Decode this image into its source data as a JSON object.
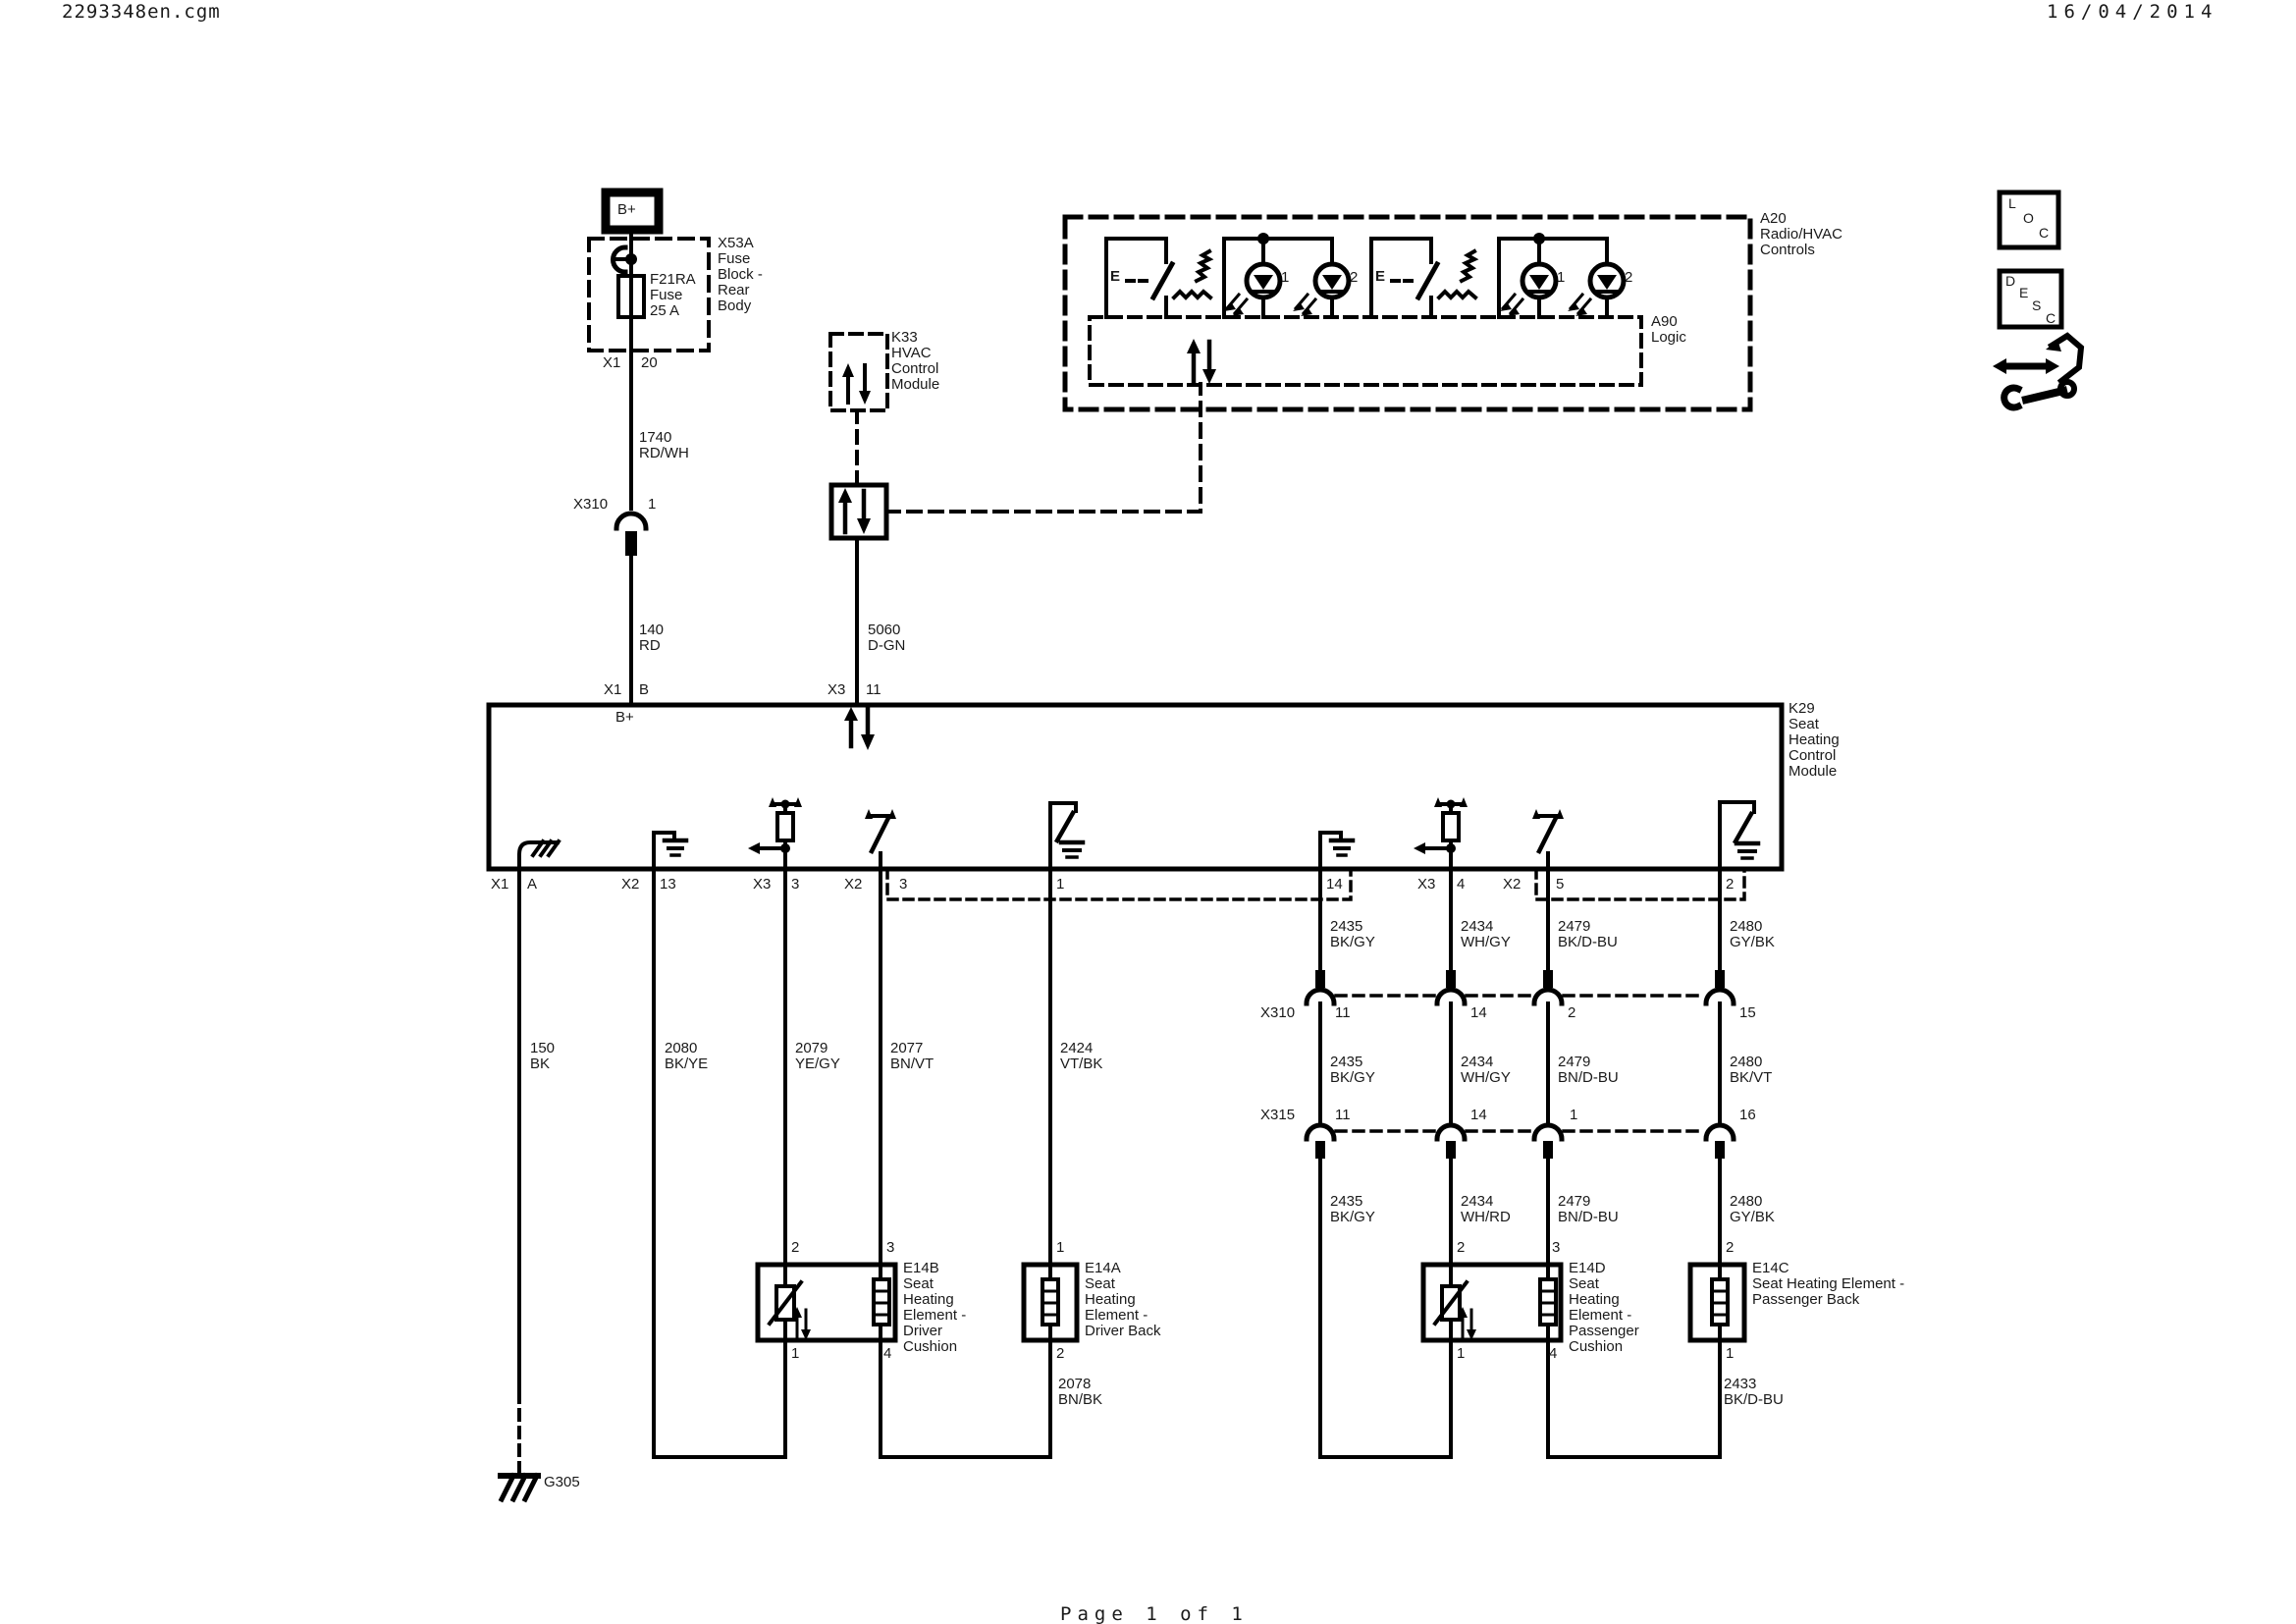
{
  "header": {
    "filename": "2293348en.cgm",
    "date": "16/04/2014"
  },
  "footer": {
    "page_label": "Page 1 of 1"
  },
  "power": {
    "bplus_label": "B+",
    "fuse_label": "F21RA\nFuse\n25 A",
    "fuse_block_label": "X53A\nFuse\nBlock -\nRear\nBody",
    "fuse_out_conn": "X1",
    "fuse_out_pin": "20",
    "wire_1740": "1740\nRD/WH",
    "x310_conn": "X310",
    "x310_pin": "1",
    "wire_140": "140\nRD"
  },
  "hvac": {
    "k33_label": "K33\nHVAC\nControl\nModule",
    "wire_5060": "5060\nD-GN"
  },
  "a20": {
    "label": "A20\nRadio/HVAC\nControls",
    "a90_label": "A90\nLogic",
    "switch_left_label": "E",
    "switch_right_label": "E",
    "led_labels": [
      "1",
      "2",
      "1",
      "2"
    ]
  },
  "k29": {
    "label": "K29\nSeat\nHeating\nControl\nModule",
    "bplus_label": "B+",
    "pin_x1b_conn": "X1",
    "pin_x1b_pin": "B",
    "pin_x311_conn": "X3",
    "pin_x311_pin": "11",
    "bottom_pins": [
      {
        "conn": "X1",
        "pin": "A"
      },
      {
        "conn": "X2",
        "pin": "13"
      },
      {
        "conn": "X3",
        "pin": "3"
      },
      {
        "conn": "X2",
        "pin": "3"
      },
      {
        "conn": "",
        "pin": "1"
      },
      {
        "conn": "",
        "pin": "14"
      },
      {
        "conn": "X3",
        "pin": "4"
      },
      {
        "conn": "X2",
        "pin": "5"
      },
      {
        "conn": "",
        "pin": "2"
      }
    ]
  },
  "wires_left": [
    "150\nBK",
    "2080\nBK/YE",
    "2079\nYE/GY",
    "2077\nBN/VT",
    "2424\nVT/BK"
  ],
  "x310_row": {
    "label": "X310",
    "pins": [
      "11",
      "14",
      "2",
      "15"
    ]
  },
  "x315_row": {
    "label": "X315",
    "pins": [
      "11",
      "14",
      "1",
      "16"
    ]
  },
  "wires_right_upper": [
    "2435\nBK/GY",
    "2434\nWH/GY",
    "2479\nBK/D-BU",
    "2480\nGY/BK"
  ],
  "wires_right_mid": [
    "2435\nBK/GY",
    "2434\nWH/GY",
    "2479\nBN/D-BU",
    "2480\nBK/VT"
  ],
  "wires_right_lower": [
    "2435\nBK/GY",
    "2434\nWH/RD",
    "2479\nBN/D-BU",
    "2480\nGY/BK"
  ],
  "elements": {
    "e14b": {
      "label": "E14B\nSeat\nHeating\nElement -\nDriver\nCushion",
      "pin_tl": "2",
      "pin_tr": "3",
      "pin_bl": "1",
      "pin_br": "4"
    },
    "e14a": {
      "label": "E14A\nSeat\nHeating\nElement -\nDriver Back",
      "pin_top": "1",
      "pin_bottom": "2",
      "wire_label": "2078\nBN/BK"
    },
    "e14d": {
      "label": "E14D\nSeat\nHeating\nElement -\nPassenger\nCushion",
      "pin_tl": "2",
      "pin_tr": "3",
      "pin_bl": "1",
      "pin_br": "4"
    },
    "e14c": {
      "label": "E14C\nSeat Heating Element -\nPassenger Back",
      "pin_top": "2",
      "pin_bottom": "1",
      "wire_label": "2433\nBK/D-BU"
    }
  },
  "ground": {
    "label": "G305"
  },
  "icons": {
    "loc": [
      "L",
      "O",
      "C"
    ],
    "desc": [
      "D",
      "E",
      "S",
      "C"
    ]
  },
  "colors": {
    "line": "#000000",
    "text": "#1a1a1a",
    "bg": "#ffffff"
  }
}
